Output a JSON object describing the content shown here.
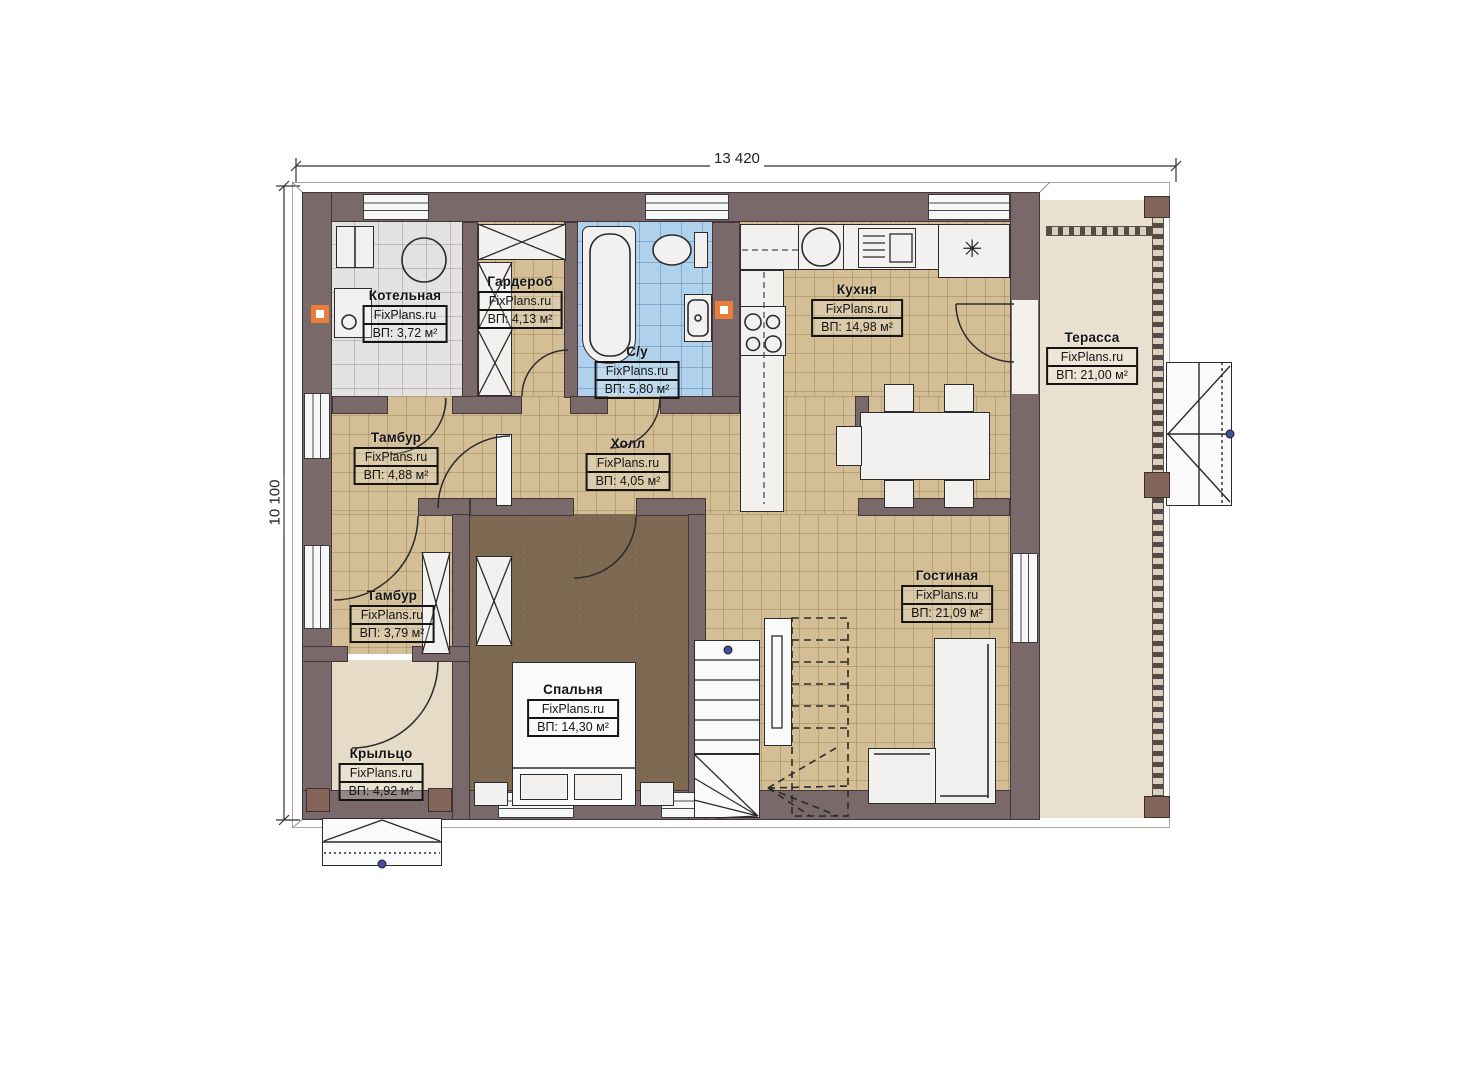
{
  "drawing": {
    "title": "План первого этажа",
    "brand": "FixPlans.ru",
    "dimensions": {
      "width_label": "13 420",
      "height_label": "10 100"
    },
    "rooms": {
      "kotelnaya": {
        "name": "Котельная",
        "brand": "FixPlans.ru",
        "area": "ВП: 3,72 м²"
      },
      "garderob": {
        "name": "Гардероб",
        "brand": "FixPlans.ru",
        "area": "ВП: 4,13 м²"
      },
      "su": {
        "name": "С/у",
        "brand": "FixPlans.ru",
        "area": "ВП: 5,80 м²"
      },
      "kuhnya": {
        "name": "Кухня",
        "brand": "FixPlans.ru",
        "area": "ВП: 14,98 м²"
      },
      "terassa": {
        "name": "Терасса",
        "brand": "FixPlans.ru",
        "area": "ВП: 21,00 м²"
      },
      "tambur1": {
        "name": "Тамбур",
        "brand": "FixPlans.ru",
        "area": "ВП: 4,88 м²"
      },
      "holl": {
        "name": "Холл",
        "brand": "FixPlans.ru",
        "area": "ВП: 4,05 м²"
      },
      "tambur2": {
        "name": "Тамбур",
        "brand": "FixPlans.ru",
        "area": "ВП: 3,79 м²"
      },
      "gostinaya": {
        "name": "Гостиная",
        "brand": "FixPlans.ru",
        "area": "ВП: 21,09 м²"
      },
      "spalnya": {
        "name": "Спальня",
        "brand": "FixPlans.ru",
        "area": "ВП: 14,30 м²"
      },
      "krylco": {
        "name": "Крыльцо",
        "brand": "FixPlans.ru",
        "area": "ВП: 4,92 м²"
      }
    },
    "icons": {
      "fridge": "✳"
    },
    "colors": {
      "wall": "#7a696a",
      "floor_tan": "#d3be96",
      "tile_gray": "#e3e2e0",
      "tile_blue": "#b0d1eb",
      "floor_bedroom": "#7e6a53",
      "terrace": "#e9e0cf",
      "accent_orange": "#e87e3a"
    }
  }
}
